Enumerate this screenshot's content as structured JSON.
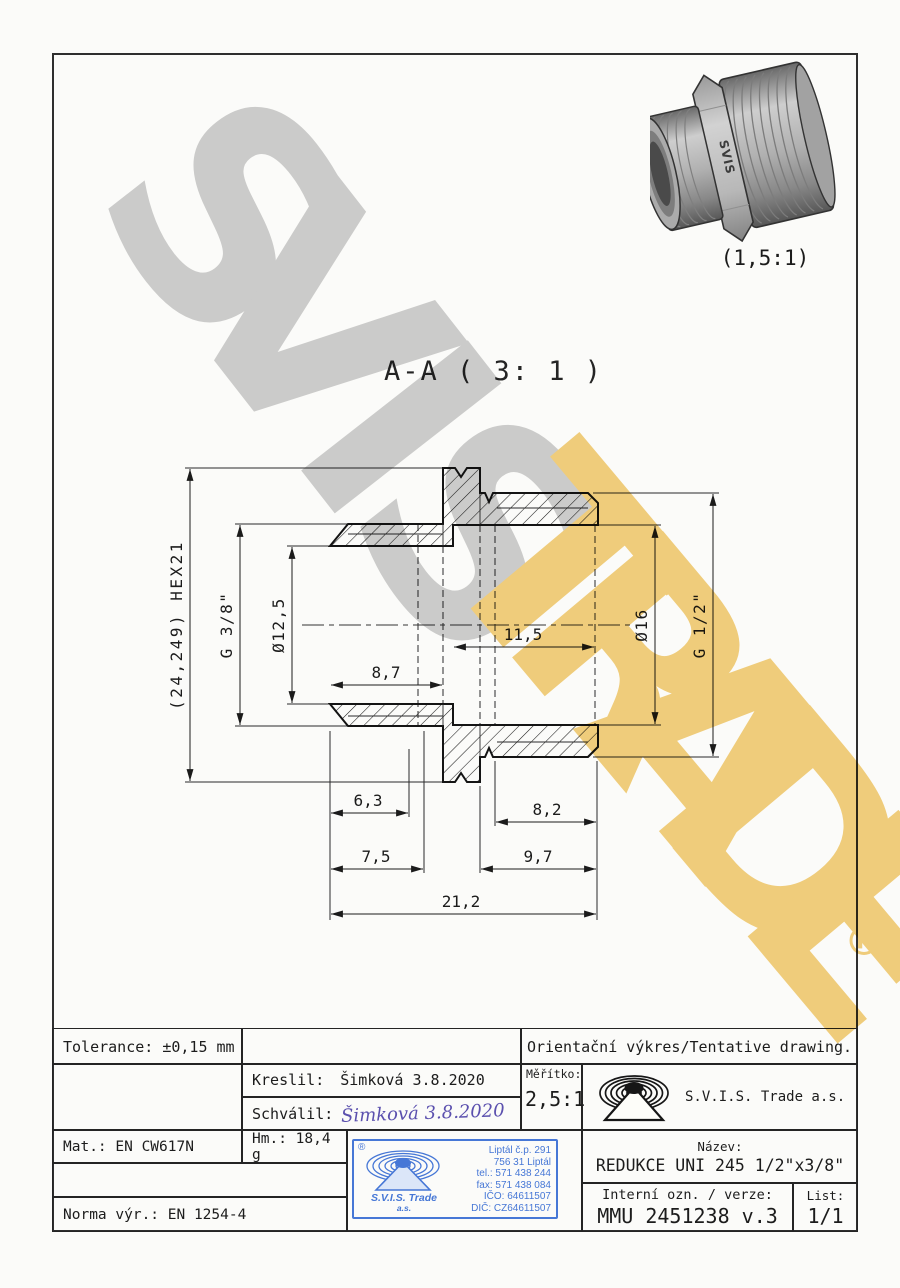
{
  "watermark": {
    "word_gray": [
      "S",
      "V",
      "I",
      "S"
    ],
    "word_gold": [
      "T",
      "R",
      "A",
      "D",
      "E"
    ],
    "registered": "®",
    "gray_color": "#cfcfcf",
    "gold_color": "#f3d07e"
  },
  "render_3d": {
    "caption": "(1,5:1)",
    "emboss": "SVIS"
  },
  "section": {
    "title": "A-A ( 3: 1 )"
  },
  "dims": {
    "overall": "(24,249) HEX21",
    "thread_small": "G 3/8\"",
    "bore_small": "Ø12,5",
    "bore_large": "Ø16",
    "thread_large": "G 1/2\"",
    "depth_large": "11,5",
    "depth_small": "8,7",
    "len_6_3": "6,3",
    "len_8_2": "8,2",
    "len_7_5": "7,5",
    "len_9_7": "9,7",
    "len_total": "21,2"
  },
  "title_block": {
    "tolerance": "Tolerance: ±0,15 mm",
    "note": "Orientační výkres/Tentative drawing.",
    "drawn_label": "Kreslil:",
    "drawn_value": "Šimková 3.8.2020",
    "approved_label": "Schválil:",
    "approved_signature": "Šimková 3.8.2020",
    "scale_label": "Měřítko:",
    "scale_value": "2,5:1",
    "company": "S.V.I.S. Trade a.s.",
    "material": "Mat.: EN CW617N",
    "weight": "Hm.: 18,4 g",
    "standard": "Norma výr.: EN 1254-4",
    "name_label": "Název:",
    "name_value": "REDUKCE UNI 245 1/2\"x3/8\"",
    "internal_label": "Interní ozn. / verze:",
    "internal_value": "MMU 2451238 v.3",
    "sheet_label": "List:",
    "sheet_value": "1/1"
  },
  "stamp": {
    "registered": "®",
    "company_line1": "S.V.I.S. Trade",
    "company_line2": "a.s.",
    "address": [
      "Liptál č.p. 291",
      "756 31 Liptál",
      "tel.: 571 438 244",
      "fax: 571 438 084",
      "IČO: 64611507",
      "DIČ: CZ64611507"
    ],
    "color": "#4677d6"
  }
}
